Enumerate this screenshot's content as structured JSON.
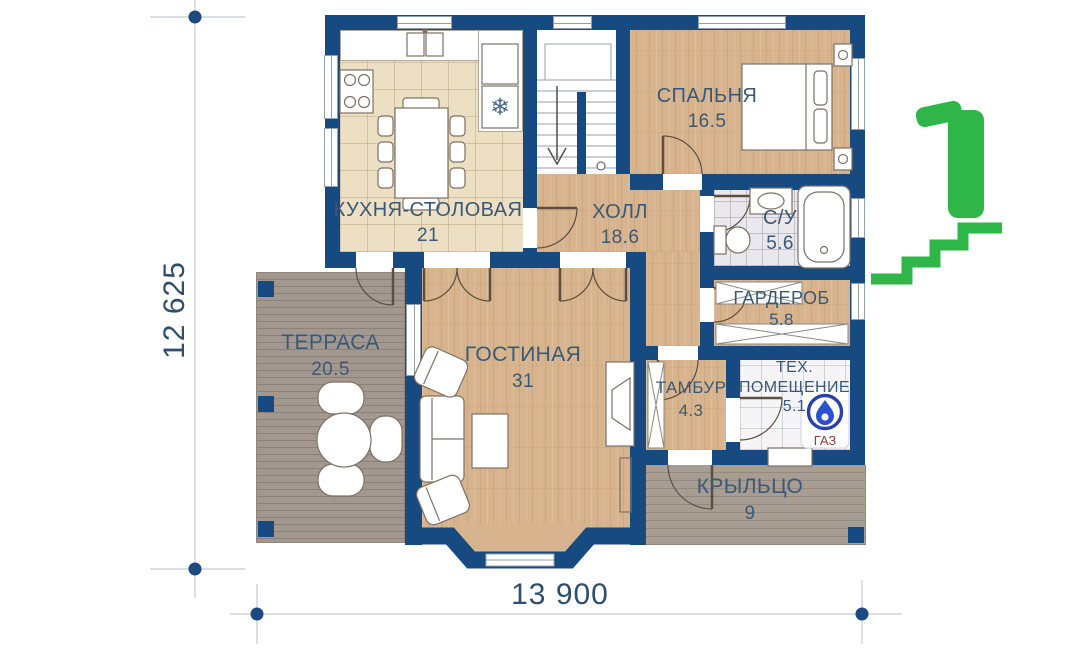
{
  "plan": {
    "rooms": [
      {
        "id": "kitchen",
        "name": "КУХНЯ-СТОЛОВАЯ",
        "area": "21"
      },
      {
        "id": "hall",
        "name": "ХОЛЛ",
        "area": "18.6"
      },
      {
        "id": "bedroom",
        "name": "СПАЛЬНЯ",
        "area": "16.5"
      },
      {
        "id": "bathroom",
        "name": "С/У",
        "area": "5.6"
      },
      {
        "id": "wardrobe",
        "name": "ГАРДЕРОБ",
        "area": "5.8"
      },
      {
        "id": "terrace",
        "name": "ТЕРРАСА",
        "area": "20.5"
      },
      {
        "id": "living",
        "name": "ГОСТИНАЯ",
        "area": "31"
      },
      {
        "id": "tambour",
        "name": "ТАМБУР",
        "area": "4.3"
      },
      {
        "id": "tech",
        "name": "ТЕХ. ПОМЕЩЕНИЕ",
        "area": "5.1"
      },
      {
        "id": "porch",
        "name": "КРЫЛЬЦО",
        "area": "9"
      }
    ],
    "dimensions": {
      "bottom": "13 900",
      "left": "12 625"
    },
    "gas_label": "ГАЗ",
    "icons": {
      "snowflake": "❄",
      "gas": "gas-flame-icon",
      "floor_logo": "first-floor-stairs-logo"
    },
    "colors": {
      "wall": "#174a80",
      "accent_green": "#2eb649",
      "gas_blue": "#2a52cc",
      "label_text": "#3a5977",
      "dimension_text": "#2d4e6f"
    }
  }
}
